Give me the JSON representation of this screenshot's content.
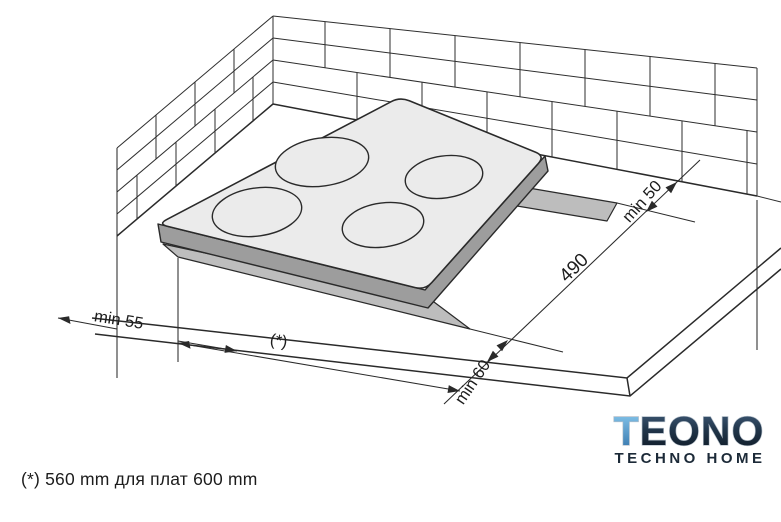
{
  "diagram": {
    "caption": "(*) 560 mm для плат 600 mm",
    "dims": {
      "side_clearance": "min 55",
      "width_ref": "(*)",
      "front_clearance": "min 60",
      "depth": "490",
      "back_clearance": "min 50"
    }
  },
  "logo": {
    "brand": "TEONO",
    "tagline": "TECHNO HOME"
  },
  "colors": {
    "line": "#2a2a2a",
    "glass": "#ebebeb",
    "hob_edge": "#9d9d9d",
    "cutout": "#bdbdbd",
    "brand_navy": "#1c2a38",
    "brand_blue": "#58a7dd"
  }
}
